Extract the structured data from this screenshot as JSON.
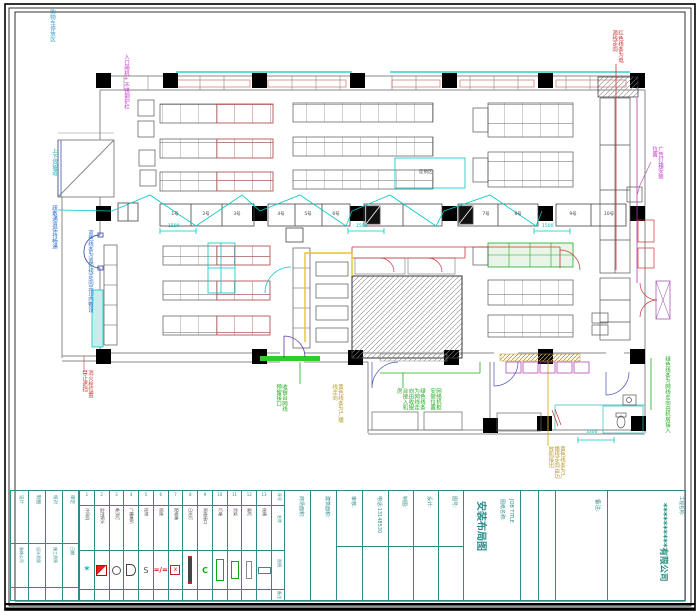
{
  "colors": {
    "wall": "#8a8a8a",
    "cad_red": "#cc4040",
    "cad_cyan": "#00b8b8",
    "cad_green": "#22aa22",
    "cad_magenta": "#c832c8",
    "cad_olive": "#b89b2a",
    "cad_blue": "#3366cc",
    "table_teal": "#2e8b8b"
  },
  "notes": {
    "blue_top": "购物车停放区",
    "magenta_entry": "入口闸机+不锈钢护栏",
    "cyan_ramp": "上下货坡道",
    "blue_side": "疏散通道保持畅通",
    "blue_wall": "蓝色线条为监控线走向吊顶内敷设",
    "red_hydrant": "消火栓位置禁止遮挡",
    "red_power": "红色线条为电源线走向",
    "magenta_lightbox": "广告灯箱安装位置",
    "green_right": "绿色线条为网线走向由机房接入",
    "green_cashier": "收银台网线预留接口",
    "olive_broadcast": "黄色线条为广播线走向",
    "green_monitor": "绿色线条为网线走向由收银台接入机房",
    "green_rack": "网络机柜安装位置",
    "olive_audio": "黄色线条为广播线走向由功放机接出",
    "promo_label": "促销区"
  },
  "dims": {
    "d1": "1500",
    "d2": "1500",
    "d3": "1500",
    "d4": "3300"
  },
  "registers": [
    "1号",
    "2号",
    "3号",
    "4号",
    "5号",
    "6号",
    "7号",
    "8号",
    "9号",
    "10号"
  ],
  "legend": {
    "row_labels": [
      "序号",
      "名称",
      "图例",
      "备注"
    ],
    "items": [
      {
        "no": "1",
        "name": "冷风机"
      },
      {
        "no": "2",
        "name": "监控探头"
      },
      {
        "no": "3",
        "name": "吸顶灯"
      },
      {
        "no": "4",
        "name": "广播喇叭"
      },
      {
        "no": "5",
        "name": "挂钩"
      },
      {
        "no": "6",
        "name": "插座"
      },
      {
        "no": "7",
        "name": "配电箱"
      },
      {
        "no": "8",
        "name": "日光灯"
      },
      {
        "no": "9",
        "name": "网络接口"
      },
      {
        "no": "10",
        "name": "灯箱"
      },
      {
        "no": "11",
        "name": "货架"
      },
      {
        "no": "12",
        "name": "展柜"
      },
      {
        "no": "13",
        "name": "线槽"
      }
    ]
  },
  "title_block": {
    "left_cols": [
      "设计",
      "制图",
      "校对",
      "审定"
    ],
    "left_notes": [
      "装饰公司",
      "设计资质",
      "施工资质",
      "日期"
    ],
    "fields": [
      "商场面积:",
      "建筑面积:",
      "审核:",
      "电话:13148530",
      "制图:",
      "设计:",
      "图号:"
    ],
    "job_title_label_cn": "图纸名称:",
    "job_title_label_en": "JOB TITLE",
    "drawing_title": "安装布局图",
    "remark_label": "备注:",
    "project_label": "工程名称:",
    "company": "**********有限公司"
  }
}
